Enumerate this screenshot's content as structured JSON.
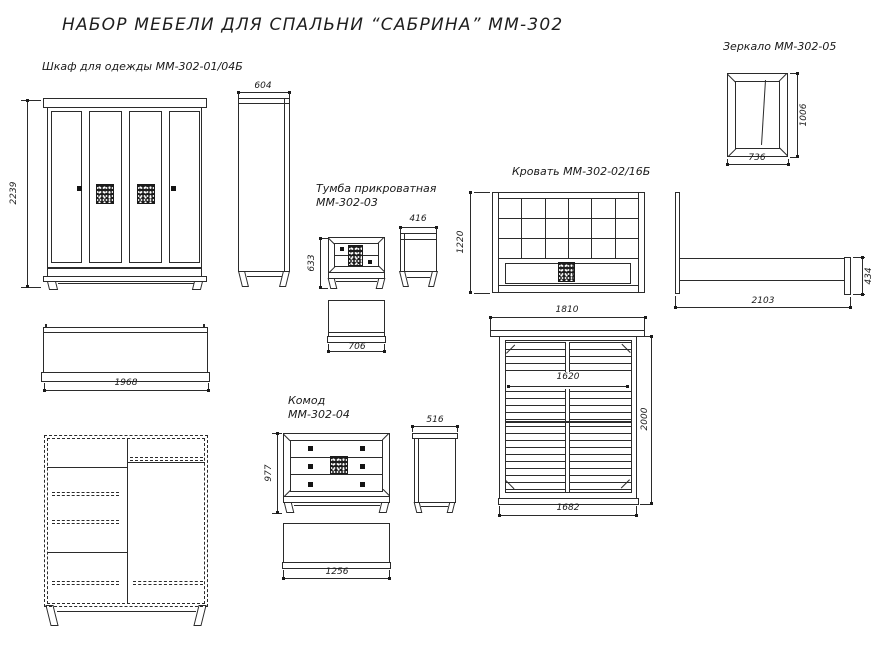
{
  "title": "НАБОР МЕБЕЛИ ДЛЯ СПАЛЬНИ “САБРИНА” ММ-302",
  "colors": {
    "line": "#2b2b2b",
    "text": "#1a1a1a",
    "background": "#ffffff",
    "handle": "#141414"
  },
  "items": {
    "wardrobe": {
      "label": "Шкаф для одежды ММ-302-01/04Б",
      "dims": {
        "height": "2239",
        "depth": "604",
        "width": "1968"
      }
    },
    "mirror": {
      "label": "Зеркало ММ-302-05",
      "dims": {
        "width": "736",
        "height": "1006"
      }
    },
    "nightstand": {
      "label_line1": "Тумба прикроватная",
      "label_line2": "ММ-302-03",
      "dims": {
        "height": "633",
        "depth": "416",
        "width": "706"
      }
    },
    "bed": {
      "label": "Кровать ММ-302-02/16Б",
      "dims": {
        "headboard_height": "1220",
        "headboard_width": "1810",
        "length": "2103",
        "footboard_height": "434",
        "berth_width": "1620",
        "berth_length": "2000",
        "frame_width": "1682"
      }
    },
    "chest": {
      "label_line1": "Комод",
      "label_line2": "ММ-302-04",
      "dims": {
        "height": "977",
        "depth": "516",
        "width": "1256"
      }
    }
  }
}
